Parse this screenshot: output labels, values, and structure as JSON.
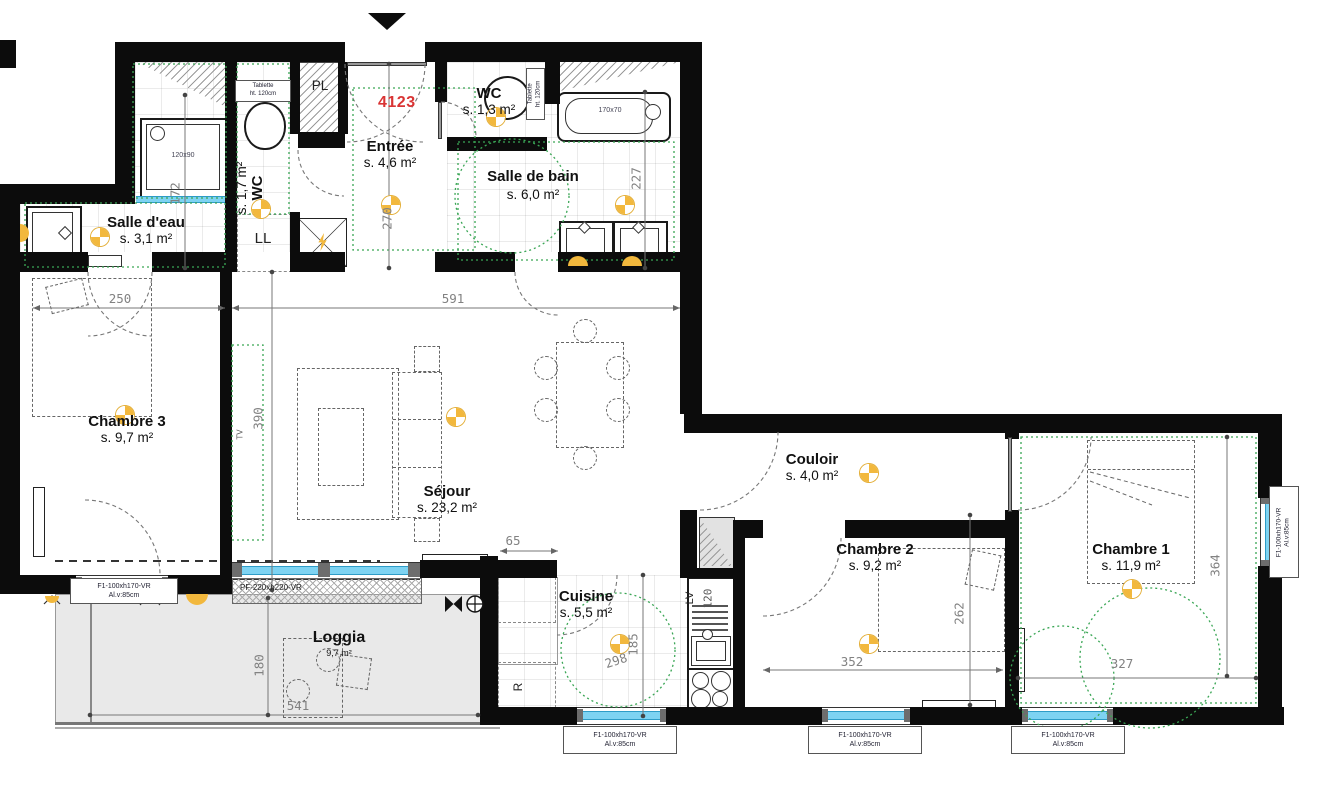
{
  "apartment": {
    "number": "4123"
  },
  "rooms": {
    "salle_eau": {
      "name": "Salle d'eau",
      "area": "s. 3,1 m²"
    },
    "wc1": {
      "name": "WC",
      "area": "s. 1,7 m²"
    },
    "entree": {
      "name": "Entrée",
      "area": "s. 4,6 m²"
    },
    "wc2": {
      "name": "WC",
      "area": "s. 1,3 m²"
    },
    "salle_de_bain": {
      "name": "Salle de bain",
      "area": "s. 6,0 m²"
    },
    "chambre3": {
      "name": "Chambre 3",
      "area": "s. 9,7 m²"
    },
    "sejour": {
      "name": "Séjour",
      "area": "s. 23,2 m²"
    },
    "couloir": {
      "name": "Couloir",
      "area": "s. 4,0 m²"
    },
    "chambre2": {
      "name": "Chambre 2",
      "area": "s. 9,2 m²"
    },
    "chambre1": {
      "name": "Chambre 1",
      "area": "s. 11,9 m²"
    },
    "cuisine": {
      "name": "Cuisine",
      "area": "s. 5,5 m²"
    },
    "loggia": {
      "name": "Loggia",
      "area": "9,7 m²"
    }
  },
  "annotations": {
    "closet": "PL",
    "washer": "LL",
    "dishwasher": "LV",
    "dishwasher_width": "120",
    "fridge": "R",
    "tv": "TV",
    "shelf_line1": "Tablette",
    "shelf_line2": "ht. 120cm",
    "shower_size": "120x90",
    "bath_size": "170x70"
  },
  "dimensions": {
    "d250": "250",
    "d591": "591",
    "d65": "65",
    "d270": "270",
    "d172": "172",
    "d227": "227",
    "d390": "390",
    "d298": "298",
    "d185": "185",
    "d541": "541",
    "d180": "180",
    "d262": "262",
    "d352": "352",
    "d327": "327",
    "d364": "364"
  },
  "windows": {
    "f1_line1": "F1-100xh170-VR",
    "f1_line2": "Al.v:85cm",
    "pf": "PF-220xh220-VR"
  },
  "colors": {
    "wall": "#0c0c0c",
    "window_glass": "#7ed3f2",
    "symbol_yellow": "#f2b83d",
    "apartment_red": "#d93434",
    "guide_green": "#3aa655",
    "loggia_fill": "#e9e9e9"
  }
}
